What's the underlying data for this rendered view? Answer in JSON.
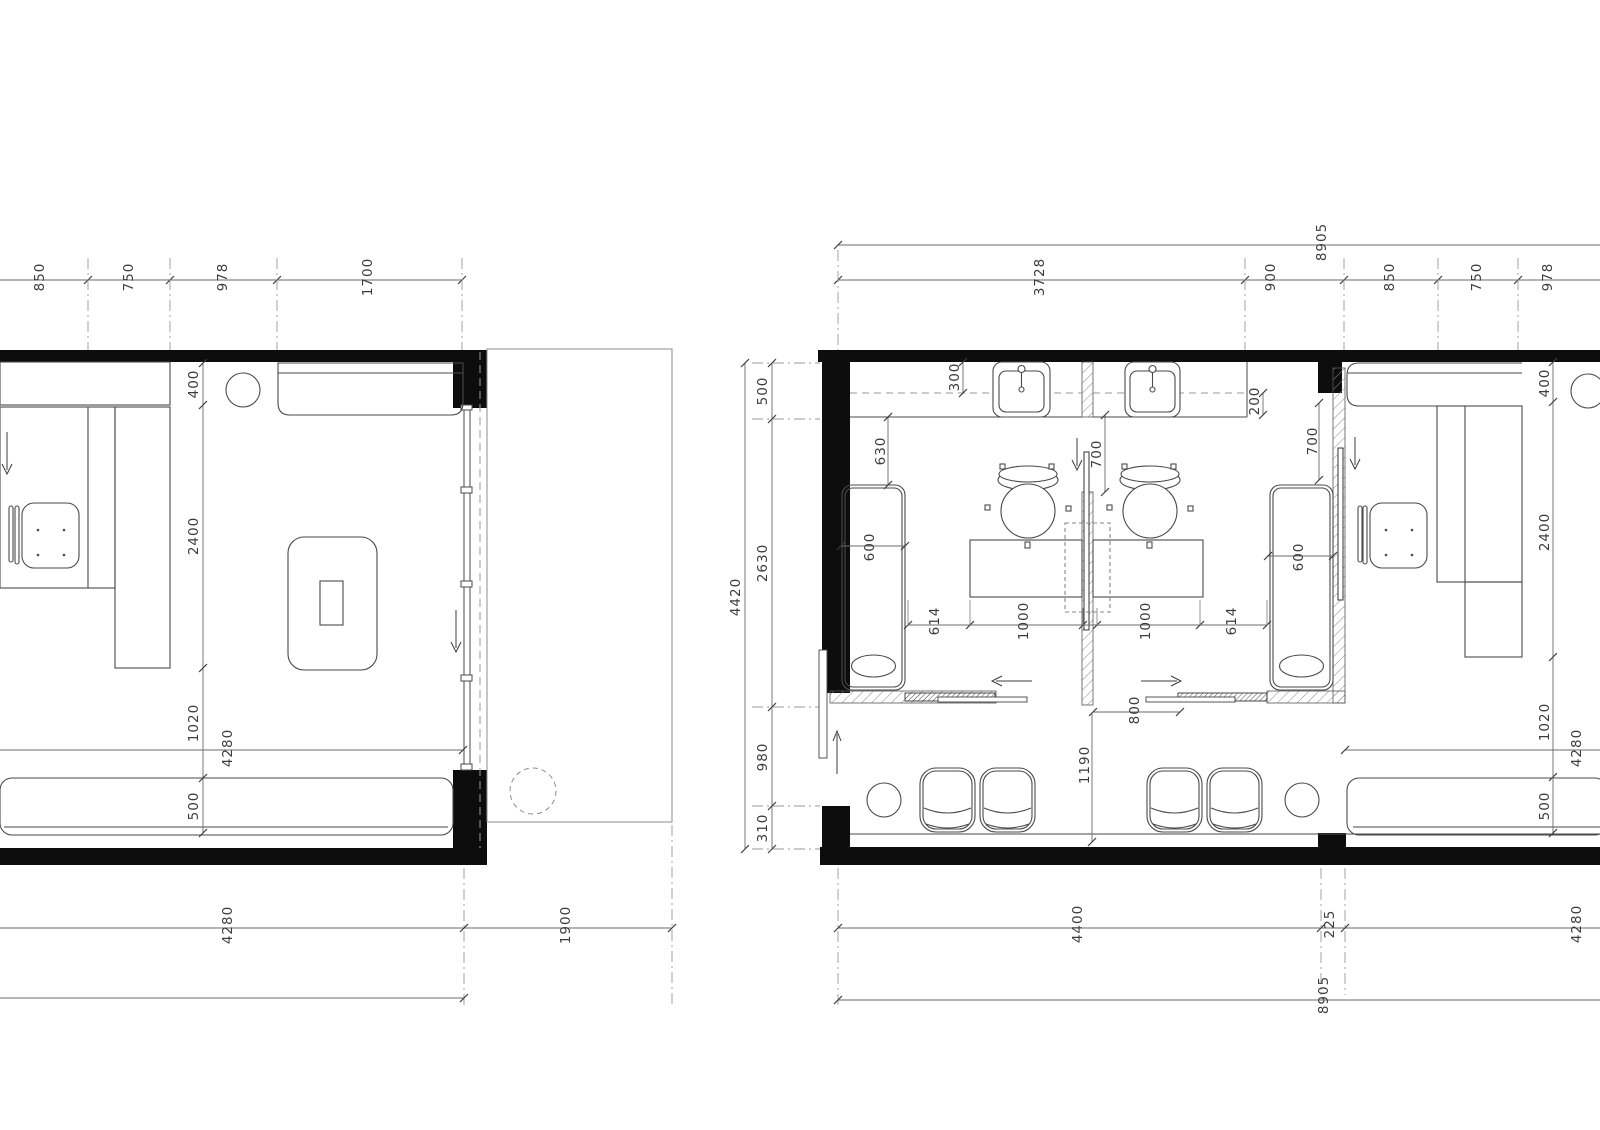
{
  "drawing": {
    "colors": {
      "wall": "#0d0d0d",
      "line": "#4a4a4a",
      "dim_line": "#6b6b6b",
      "hatch": "#8a8a8a",
      "text": "#3c3c3c",
      "background": "#ffffff"
    }
  },
  "dim_labels": [
    {
      "text": "850",
      "x": 40,
      "y": 277,
      "group": "left-top-chain"
    },
    {
      "text": "750",
      "x": 129,
      "y": 277,
      "group": "left-top-chain"
    },
    {
      "text": "978",
      "x": 223,
      "y": 277,
      "group": "left-top-chain"
    },
    {
      "text": "1700",
      "x": 368,
      "y": 277,
      "group": "left-top-chain"
    },
    {
      "text": "400",
      "x": 194,
      "y": 384,
      "group": "left-interior-chain"
    },
    {
      "text": "2400",
      "x": 194,
      "y": 536,
      "group": "left-interior-chain"
    },
    {
      "text": "1020",
      "x": 194,
      "y": 723,
      "group": "left-interior-chain"
    },
    {
      "text": "500",
      "x": 194,
      "y": 806,
      "group": "left-interior-chain"
    },
    {
      "text": "4280",
      "x": 228,
      "y": 748,
      "group": "left-interior-width"
    },
    {
      "text": "4280",
      "x": 228,
      "y": 925,
      "group": "left-bottom-chain"
    },
    {
      "text": "1900",
      "x": 566,
      "y": 925,
      "group": "left-bottom-chain"
    },
    {
      "text": "8905",
      "x": 1322,
      "y": 242,
      "group": "right-top-overall"
    },
    {
      "text": "3728",
      "x": 1040,
      "y": 277,
      "group": "right-top-chain"
    },
    {
      "text": "900",
      "x": 1271,
      "y": 277,
      "group": "right-top-chain"
    },
    {
      "text": "850",
      "x": 1390,
      "y": 277,
      "group": "right-top-chain"
    },
    {
      "text": "750",
      "x": 1477,
      "y": 277,
      "group": "right-top-chain"
    },
    {
      "text": "978",
      "x": 1548,
      "y": 277,
      "group": "right-top-chain"
    },
    {
      "text": "4420",
      "x": 736,
      "y": 597,
      "group": "right-left-overall"
    },
    {
      "text": "500",
      "x": 763,
      "y": 391,
      "group": "right-left-chain"
    },
    {
      "text": "2630",
      "x": 763,
      "y": 563,
      "group": "right-left-chain"
    },
    {
      "text": "980",
      "x": 763,
      "y": 757,
      "group": "right-left-chain"
    },
    {
      "text": "310",
      "x": 763,
      "y": 828,
      "group": "right-left-chain"
    },
    {
      "text": "300",
      "x": 955,
      "y": 377,
      "group": "right-interior"
    },
    {
      "text": "630",
      "x": 881,
      "y": 451,
      "group": "right-interior"
    },
    {
      "text": "600",
      "x": 870,
      "y": 547,
      "group": "right-interior"
    },
    {
      "text": "700",
      "x": 1097,
      "y": 454,
      "group": "right-interior"
    },
    {
      "text": "700",
      "x": 1313,
      "y": 441,
      "group": "right-interior"
    },
    {
      "text": "200",
      "x": 1255,
      "y": 401,
      "group": "right-interior"
    },
    {
      "text": "600",
      "x": 1299,
      "y": 557,
      "group": "right-interior"
    },
    {
      "text": "614",
      "x": 935,
      "y": 621,
      "group": "right-middle-chain"
    },
    {
      "text": "1000",
      "x": 1024,
      "y": 621,
      "group": "right-middle-chain"
    },
    {
      "text": "1000",
      "x": 1146,
      "y": 621,
      "group": "right-middle-chain"
    },
    {
      "text": "614",
      "x": 1232,
      "y": 621,
      "group": "right-middle-chain"
    },
    {
      "text": "800",
      "x": 1135,
      "y": 710,
      "group": "right-interior"
    },
    {
      "text": "1190",
      "x": 1085,
      "y": 765,
      "group": "right-interior"
    },
    {
      "text": "400",
      "x": 1545,
      "y": 383,
      "group": "right-right-chain"
    },
    {
      "text": "2400",
      "x": 1545,
      "y": 532,
      "group": "right-right-chain"
    },
    {
      "text": "1020",
      "x": 1545,
      "y": 722,
      "group": "right-right-chain"
    },
    {
      "text": "500",
      "x": 1545,
      "y": 806,
      "group": "right-right-chain"
    },
    {
      "text": "4280",
      "x": 1577,
      "y": 748,
      "group": "right-interior-width"
    },
    {
      "text": "4400",
      "x": 1078,
      "y": 924,
      "group": "right-bottom-chain"
    },
    {
      "text": "225",
      "x": 1330,
      "y": 924,
      "group": "right-bottom-chain"
    },
    {
      "text": "4280",
      "x": 1577,
      "y": 924,
      "group": "right-bottom-chain"
    },
    {
      "text": "8905",
      "x": 1324,
      "y": 995,
      "group": "right-bottom-overall"
    }
  ]
}
